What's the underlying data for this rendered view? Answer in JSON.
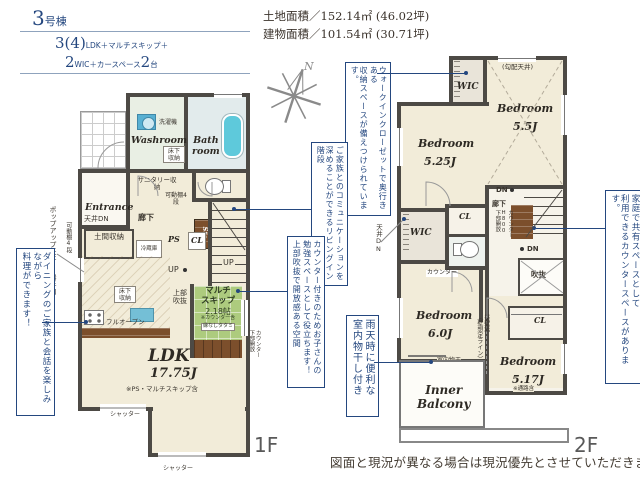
{
  "header": {
    "building_no": "3",
    "building_no_suffix": "号棟",
    "plan_num1": "3(4)",
    "plan_text1": "LDK＋マルチスキップ＋",
    "plan_num2": "2",
    "plan_text2": "WIC＋カースペース",
    "plan_num3": "2",
    "plan_text3": "台",
    "land_area": "土地面積／152.14㎡ (46.02坪)",
    "building_area": "建物面積／101.54㎡ (30.71坪)"
  },
  "compass": {
    "north": "N"
  },
  "floor1": {
    "floor_label": "1F",
    "washroom": "Washroom",
    "washing_machine": "洗濯機",
    "underfloor_storage_1": "床下収納",
    "bathroom_l1": "Bath",
    "bathroom_l2": "room",
    "entrance": "Entrance",
    "sanitary_storage": "サニタリー収納",
    "hallway": "廊下",
    "movable_shelf_hall": "可動棚4段",
    "movable_shelf_left": "可動棚4段",
    "ceiling_dn": "天井DN",
    "popup_ceiling": "ポップアップ天井",
    "back_door": "勝手口",
    "storage_sto": "Sto.",
    "doma_storage": "土間収納",
    "fridge": "冷蔵庫",
    "ps": "PS",
    "cl": "CL",
    "up_1": "UP",
    "up_2": "UP",
    "underfloor_storage_2": "床下収納",
    "full_open": "フルオープン",
    "upper_void": "上部吹抜",
    "multi_skip_l1": "マルチ",
    "multi_skip_l2": "スキップ",
    "multi_skip_size": "2.18帖",
    "multi_skip_note1": "※カウンター含",
    "multi_skip_note2": "縁なしタタミ",
    "counter_lower_open_1": "カウンター",
    "counter_lower_open_2": "下部開放",
    "ldk": "LDK",
    "ldk_size": "17.75J",
    "ldk_note": "※PS・マルチスキップ含",
    "shutter_1": "シャッター",
    "shutter_2": "シャッター"
  },
  "floor2": {
    "floor_label": "2F",
    "wic_top": "WIC",
    "sloped_ceiling": "(勾配天井)",
    "bedroom_55": "Bedroom",
    "bedroom_55_size": "5.5J",
    "bedroom_525": "Bedroom",
    "bedroom_525_size": "5.25J",
    "dn_1": "DN",
    "hallway": "廊下",
    "counter_h800_1": "カウンター",
    "counter_h800_2": "H800",
    "counter_h800_3": "下部開放",
    "ceiling_dn": "天井DN",
    "wic_mid": "WIC",
    "cl_1": "CL",
    "counter": "カウンター",
    "dn_2": "DN",
    "void": "吹抜",
    "bedroom_60": "Bedroom",
    "bedroom_60_size": "6.0J",
    "indoor_drying": "室内物干",
    "indoor_drying_sub": "吊下げ式",
    "no_wall_1": "垂壁無",
    "no_wall_2": "（壁想定ライン）",
    "cl_2": "CL",
    "bedroom_517": "Bedroom",
    "bedroom_517_size": "5.17J",
    "bedroom_517_note": "※通路含",
    "inner_balcony_l1": "Inner",
    "inner_balcony_l2": "Balcony"
  },
  "annotations": {
    "dining": {
      "col1": "ダイニングのご家族と会話を楽しみながら",
      "col2": "料理ができます！"
    },
    "wic": {
      "col1": "ウォークインクローゼットで奥行きある",
      "col2": "収納スペースが備えつけられています。"
    },
    "stairs": {
      "col1": "ご家族とのコミュニケーションを",
      "col2": "深めることができるリビングイン階段"
    },
    "counter": {
      "col1": "カウンター付きのためお子さんの",
      "col2": "勉強スペースとして役立ちます！",
      "col3": "上部吹抜で開放感ある空間"
    },
    "shared_counter": {
      "col1": "家庭で共有スペースとして",
      "col2": "利用できるカウンタースペースがあります。"
    },
    "drying": {
      "col1": "雨天時に便利な",
      "col2": "室内物干し付き"
    }
  },
  "footer": {
    "disclaimer": "図面と現況が異なる場合は現況優先とさせていただきます。"
  },
  "colors": {
    "accent_blue": "#24477f",
    "wall": "#4d4a45",
    "floor_cream": "#f2ecd9",
    "tatami_green": "#adcb7e",
    "wood_brown": "#7c4f2c",
    "bathtub_blue": "#5ec9db"
  }
}
